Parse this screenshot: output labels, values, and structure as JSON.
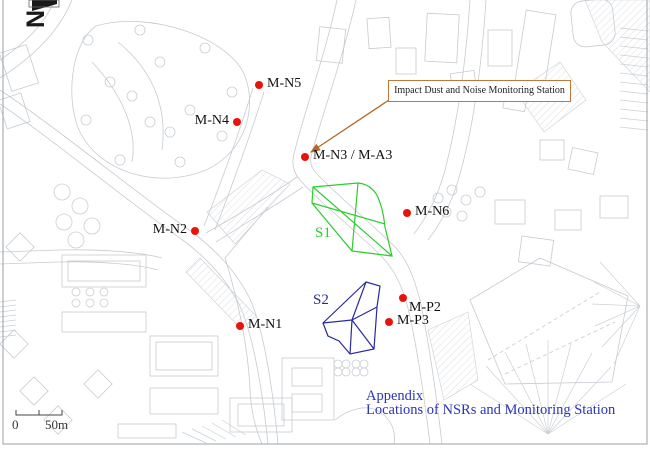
{
  "figure": {
    "title_line1": "Appendix",
    "title_line2": "Locations of NSRs and Monitoring Station",
    "title_color": "#2b35b5"
  },
  "north_arrow": {
    "label": "N"
  },
  "scale_bar": {
    "zero_label": "0",
    "distance_label": "50m"
  },
  "callout": {
    "text": "Impact Dust and Noise Monitoring Station",
    "border_color": "#c0793a",
    "arrow_color": "#b06a28"
  },
  "marker": {
    "color": "#e8140c"
  },
  "stations": [
    {
      "label": "M-N5"
    },
    {
      "label": "M-N4"
    },
    {
      "label": "M-N3 / M-A3"
    },
    {
      "label": "M-N6"
    },
    {
      "label": "M-N2"
    },
    {
      "label": "M-N1"
    },
    {
      "label": "M-P2"
    },
    {
      "label": "M-P3"
    }
  ],
  "sites": [
    {
      "label": "S1",
      "color": "#2ecc2e"
    },
    {
      "label": "S2",
      "color": "#2a2aa0"
    }
  ]
}
